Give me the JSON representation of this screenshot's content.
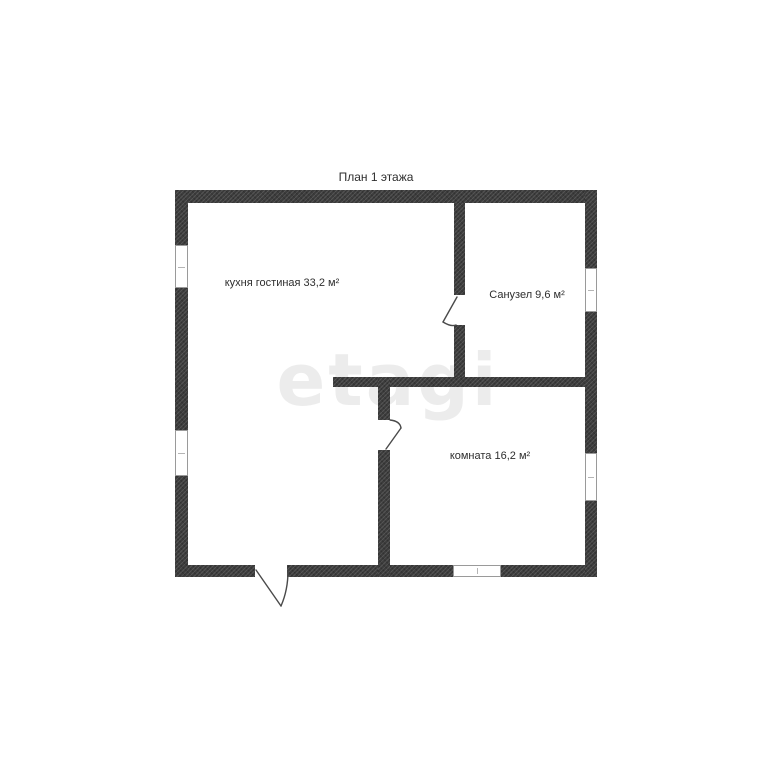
{
  "title": "План 1 этажа",
  "watermark": "etagi",
  "rooms": [
    {
      "name": "kitchen-living-room",
      "label": "кухня гостиная 33,2 м²",
      "area_m2": "33,2"
    },
    {
      "name": "bathroom",
      "label": "Санузел 9,6 м²",
      "area_m2": "9,6"
    },
    {
      "name": "room",
      "label": "комната 16,2 м²",
      "area_m2": "16,2"
    }
  ],
  "colors": {
    "background": "#ffffff",
    "wall": "#3c3c3c",
    "text": "#2e2e2e",
    "watermark": "#ececec",
    "window_frame": "#9a9a9a"
  }
}
